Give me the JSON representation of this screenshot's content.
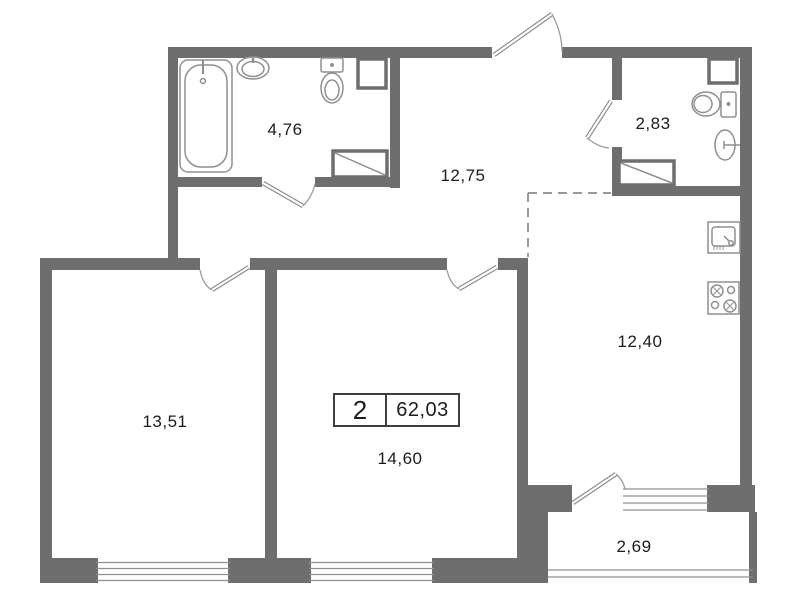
{
  "title": "apartment-floor-plan",
  "areas": {
    "bathroom": "4,76",
    "wc": "2,83",
    "hallway": "12,75",
    "kitchen": "12,40",
    "room1": "13,51",
    "room2": "14,60",
    "balcony": "2,69"
  },
  "summary": {
    "rooms": "2",
    "total_area": "62,03"
  },
  "icons": [
    "bathtub-icon",
    "sink-icon",
    "toilet-icon",
    "ventilation-shaft-icon",
    "washing-machine-icon",
    "kitchen-sink-icon",
    "stove-icon",
    "door-leaf",
    "door-swing-arc",
    "window-glazing",
    "balcony-railing"
  ],
  "colors": {
    "wall": "#6e6e6e",
    "fixture_outline": "#8f8f8f",
    "door_leaf": "#8a8a8a",
    "dashed_boundary": "#9a9a9a",
    "text": "#1c1c1c",
    "background": "#ffffff",
    "summary_border": "#3f3f3f"
  }
}
